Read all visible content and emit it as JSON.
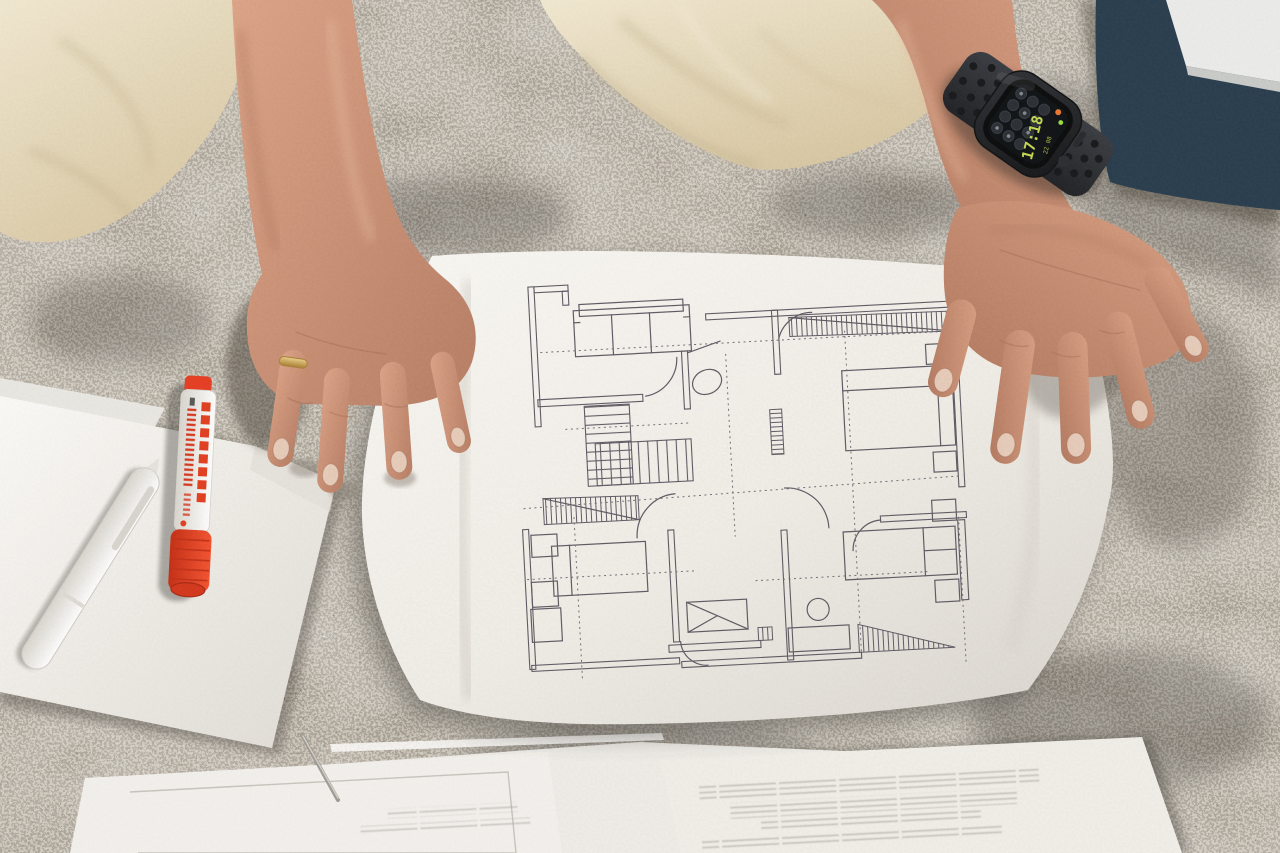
{
  "scene": {
    "description": "Overhead photo: a kneeling person's hands hold an architectural floor plan on a patterned grey carpet; a red marker, white pen and printed documents lie around",
    "colors": {
      "carpet_base": "#8e887d",
      "carpet_dark": "#2e2a25",
      "carpet_light": "#d9d3c7",
      "paper": "#f4f2ee",
      "plan_line": "#5b5761",
      "plan_dash": "#6f6b73",
      "skin": "#cc9479",
      "skin_shadow": "#96634e",
      "fabric_beige": "#ecdfc2",
      "marker_red": "#e63a1e",
      "marker_body": "#f4f1ec",
      "watch_band": "#27292d",
      "watch_case": "#17191c",
      "watch_screen": "#0a0d10",
      "watch_green": "#c6d94e",
      "watch_orange": "#e8762c",
      "folder_navy": "#24394a",
      "ring_gold": "#c9a24a"
    }
  },
  "watch": {
    "time": "17:18",
    "secondary_text": "22 08"
  },
  "floor_plan": {
    "type": "architectural-drawing",
    "elements": [
      "exterior-walls",
      "interior-walls",
      "sofa",
      "main-staircase",
      "winder-stair-hatching",
      "hallway",
      "toilet",
      "shower",
      "wash-basin",
      "double-bed-top-right",
      "bed-bottom-left",
      "double-bed-bottom-right",
      "nightstands",
      "door-swing-arcs",
      "window-hatch-bands",
      "dashed-axis-lines"
    ]
  }
}
